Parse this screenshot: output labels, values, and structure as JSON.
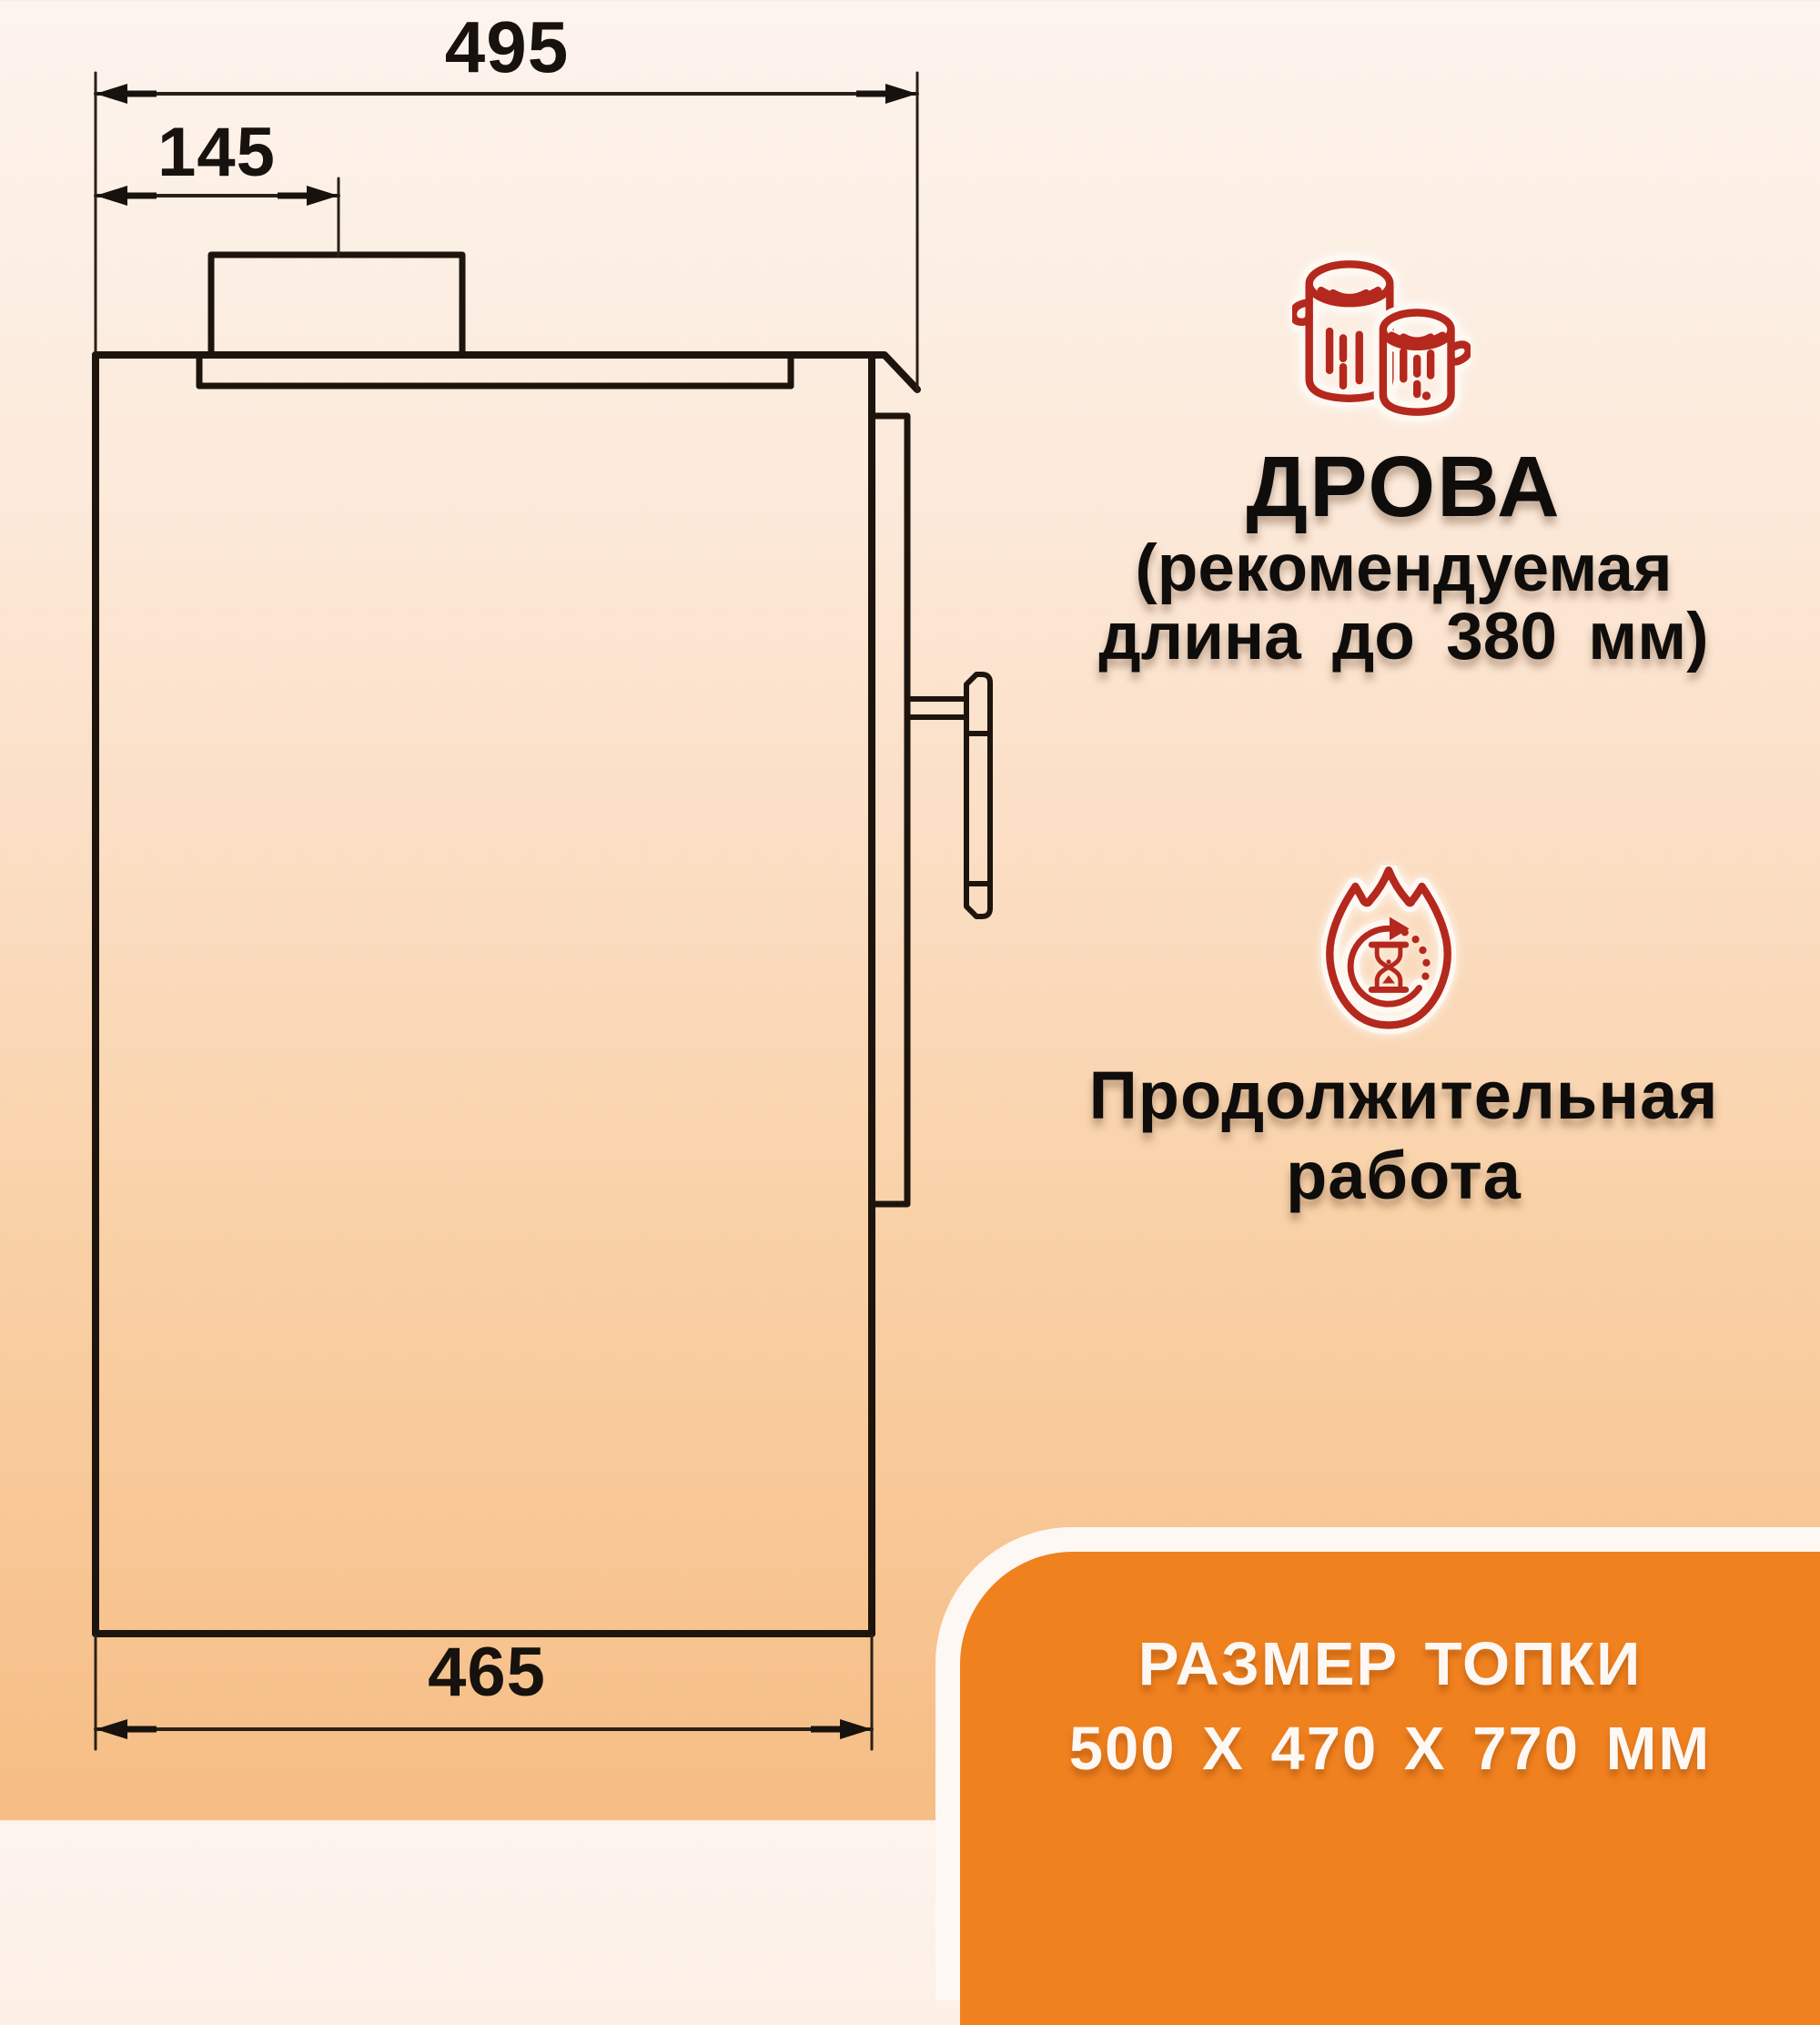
{
  "drawing": {
    "dim_top_width": "495",
    "dim_chimney_offset": "145",
    "dim_bottom_width": "465"
  },
  "firewood": {
    "icon": "logs-icon",
    "title": "ДРОВА",
    "subtitle_line1": "(рекомендуемая",
    "subtitle_line2": "длина до 380 мм)"
  },
  "duration": {
    "icon": "fire-hourglass-icon",
    "line1": "Продолжительная",
    "line2": "работа"
  },
  "banner": {
    "line1": "РАЗМЕР ТОПКИ",
    "line2": "500 X 470 X 770 ММ"
  },
  "colors": {
    "accent_orange": "#f0811f",
    "icon_red": "#b5281d",
    "line_dark": "#1d140d",
    "banner_text": "#fdf8f4"
  }
}
